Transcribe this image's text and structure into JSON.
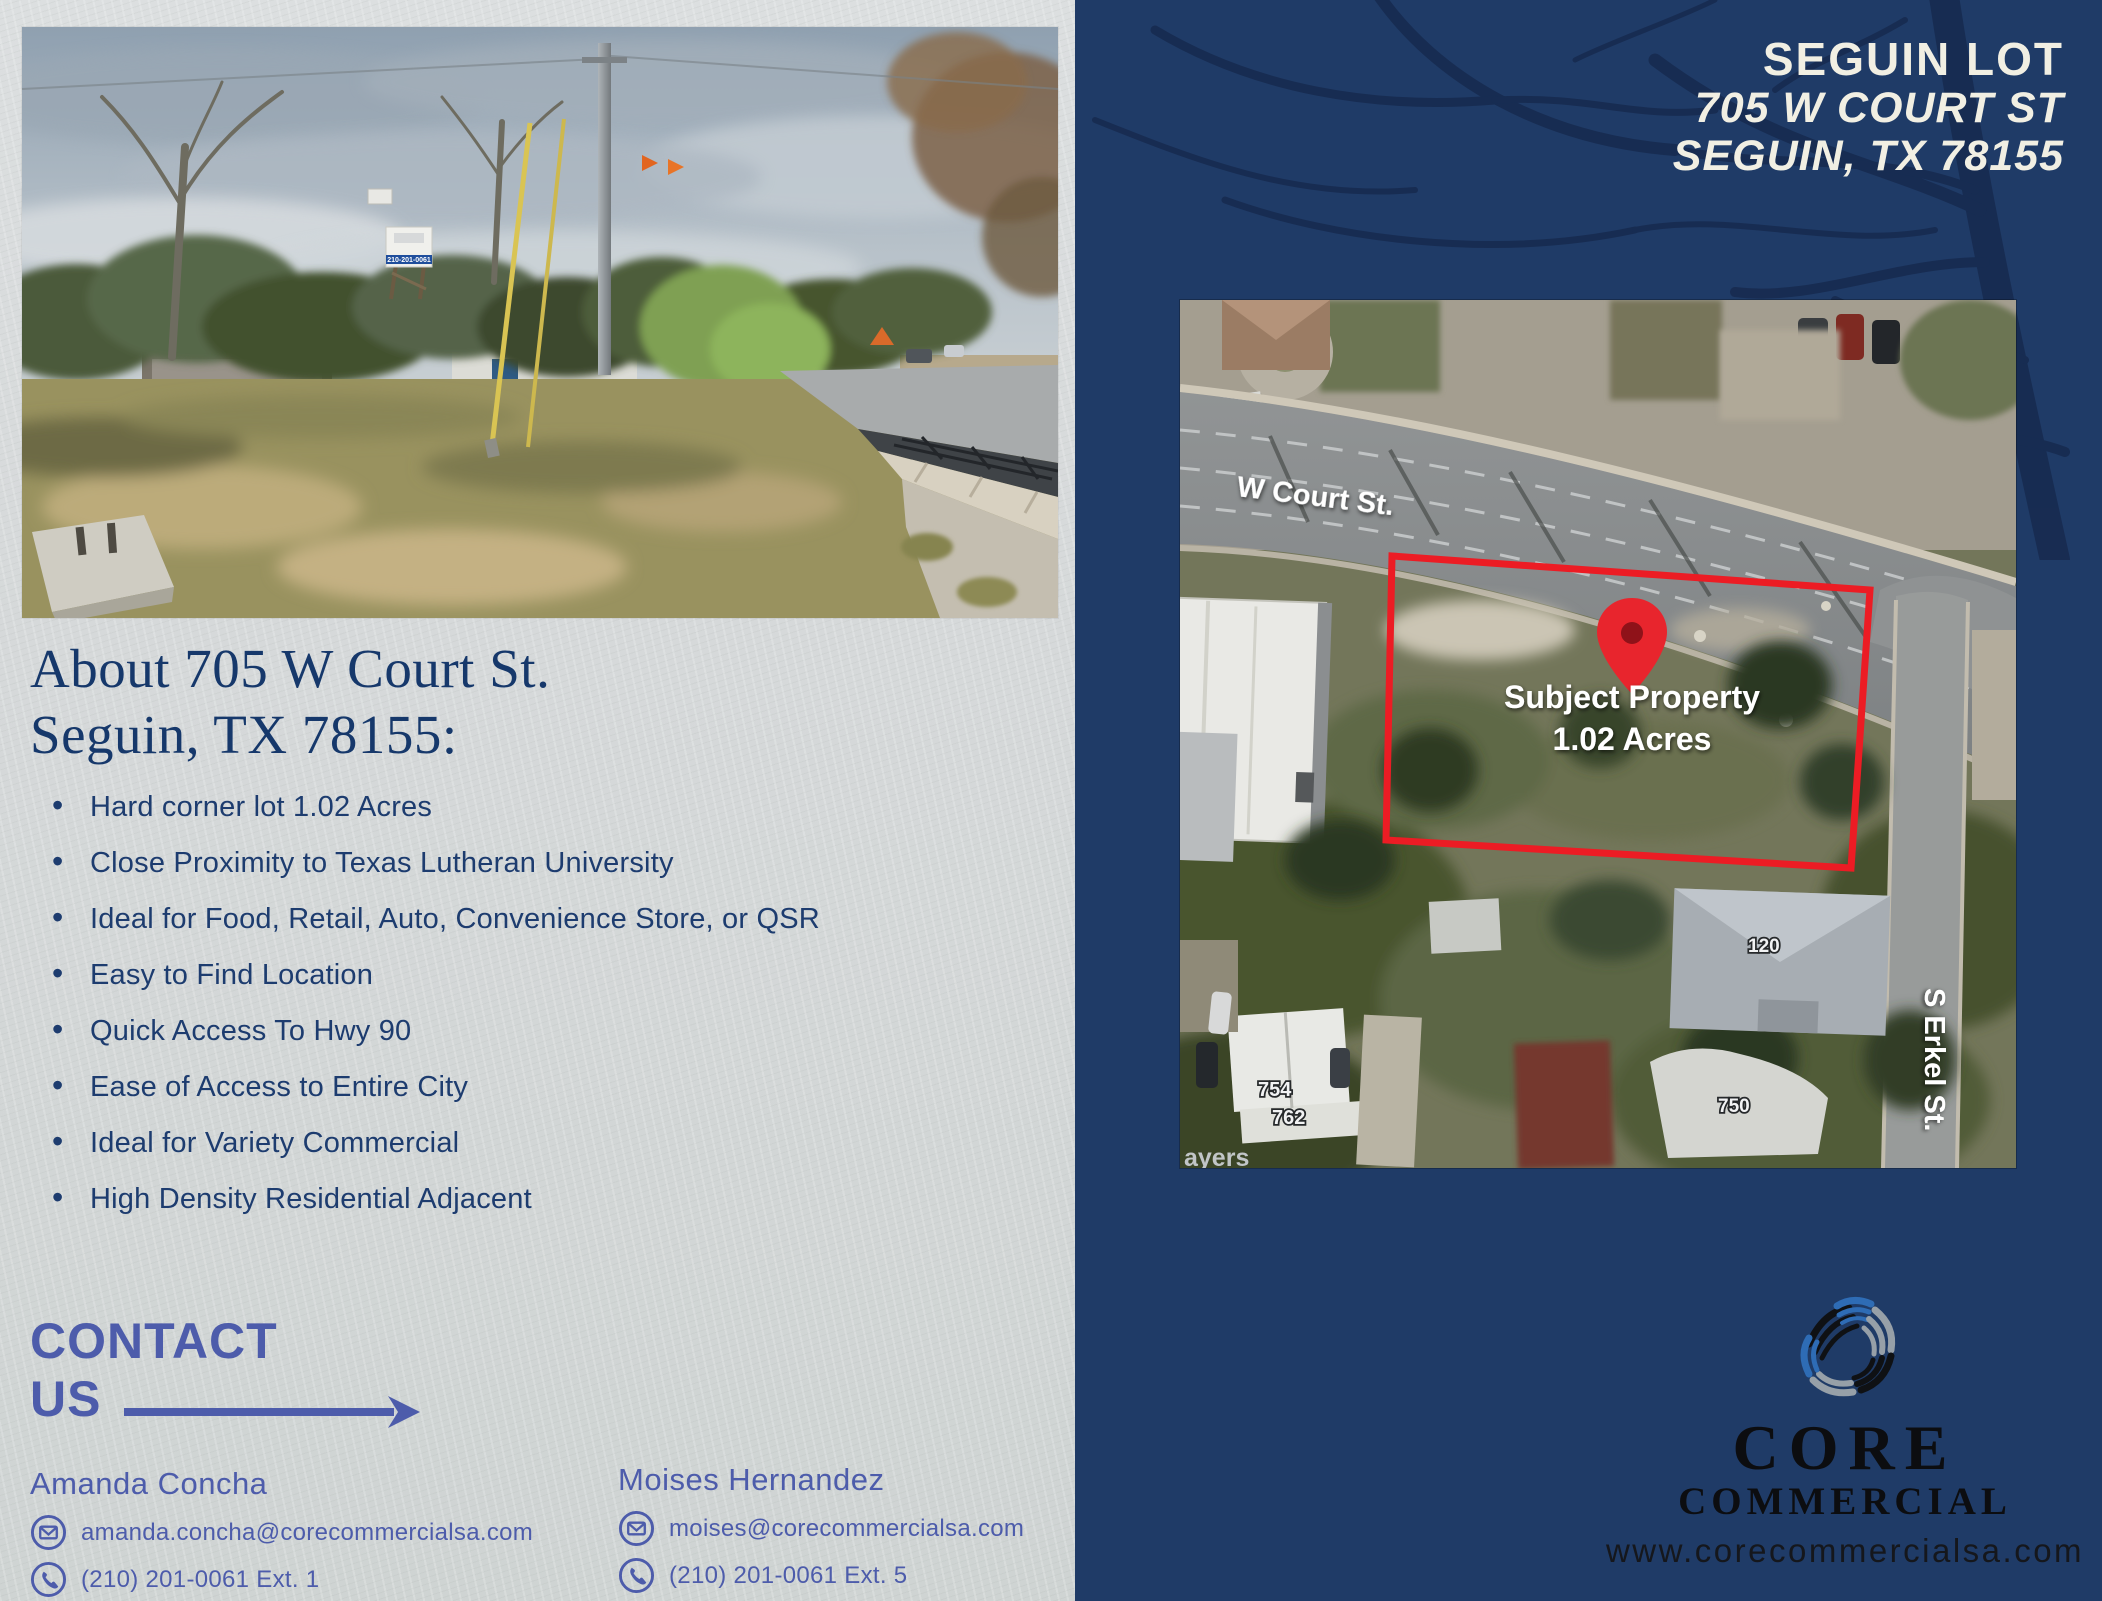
{
  "header": {
    "line1": "SEGUIN LOT",
    "line2": "705 W COURT ST",
    "line3": "SEGUIN, TX 78155"
  },
  "about": {
    "heading_line1": "About 705 W Court St.",
    "heading_line2": "Seguin, TX 78155:",
    "bullets": [
      "Hard corner lot 1.02 Acres",
      "Close Proximity to Texas Lutheran University",
      "Ideal for Food, Retail, Auto, Convenience Store, or QSR",
      "Easy to Find Location",
      "Quick Access To Hwy 90",
      "Ease of Access to Entire City",
      "Ideal for Variety Commercial",
      "High Density Residential Adjacent"
    ]
  },
  "contact": {
    "heading_line1": "CONTACT",
    "heading_line2": "US",
    "agents": [
      {
        "name": "Amanda Concha",
        "email": "amanda.concha@corecommercialsa.com",
        "phone": "(210) 201-0061 Ext. 1"
      },
      {
        "name": "Moises Hernandez",
        "email": "moises@corecommercialsa.com",
        "phone": "(210) 201-0061 Ext. 5"
      }
    ]
  },
  "map": {
    "street_label": "W Court St.",
    "subject_line1": "Subject Property",
    "subject_line2": "1.02 Acres",
    "side_street_label": "S Erkel St.",
    "house_numbers": [
      "120",
      "750",
      "754",
      "762"
    ],
    "partial_label": "ayers"
  },
  "photo": {
    "sign_phone": "210-201-0061"
  },
  "logo": {
    "line1": "CORE",
    "line2": "COMMERCIAL",
    "website": "www.corecommercialsa.com"
  },
  "colors": {
    "navy_background": "#1F3B67",
    "title_cream": "#F1EFE3",
    "contact_blue": "#4D5CAB",
    "heading_navy": "#16386B",
    "boundary_red": "#EC1C24",
    "logo_blue": "#2E6CB5",
    "logo_gray": "#97A0A8",
    "logo_black": "#111111"
  }
}
